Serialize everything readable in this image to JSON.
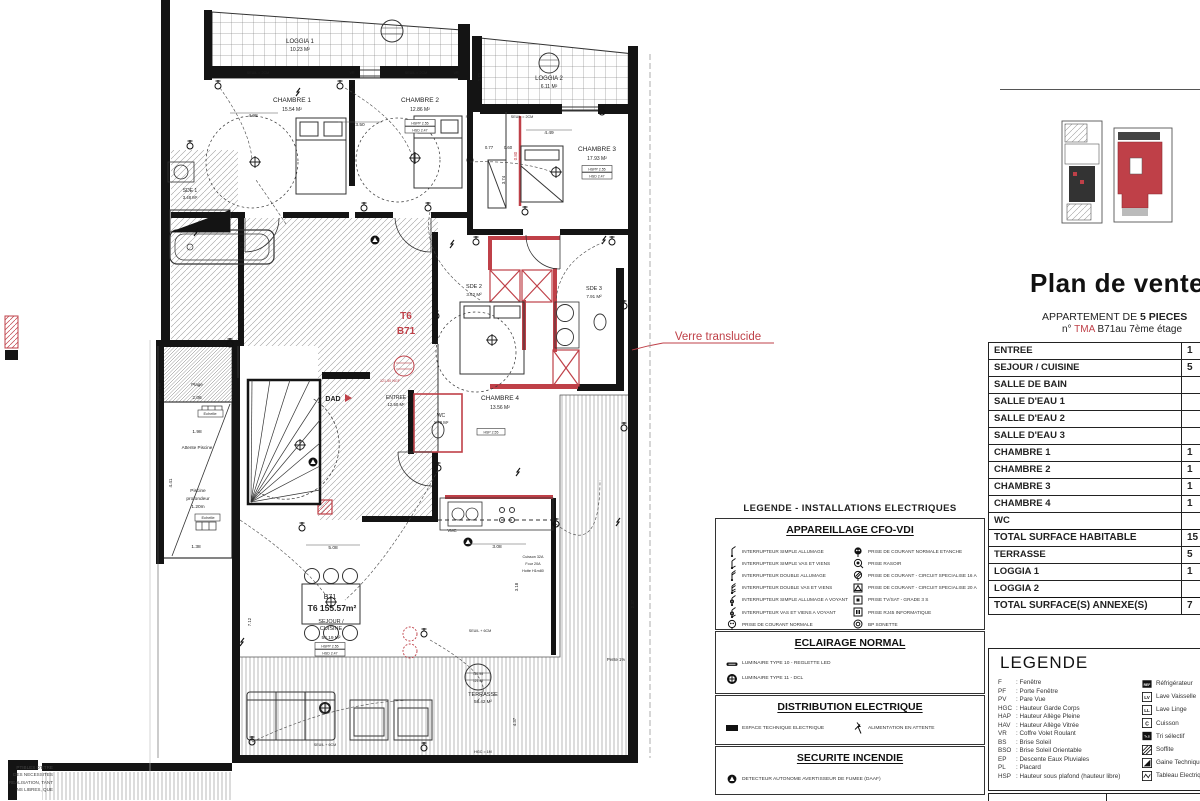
{
  "colors": {
    "accent_red": "#bf4048",
    "wall": "#141414",
    "hatch_gray": "#999999"
  },
  "title_block": {
    "title": "Plan de vente",
    "subtitle_prefix": "APPARTEMENT DE ",
    "subtitle_bold": "5 PIECES",
    "line2_prefix": "n° ",
    "line2_red": "TMA",
    "line2_suffix": " B71au 7ème étage"
  },
  "surface_table": {
    "rows": [
      {
        "label": "ENTREE",
        "value": "1",
        "total": false
      },
      {
        "label": "SEJOUR / CUISINE",
        "value": "5",
        "total": false
      },
      {
        "label": "SALLE DE BAIN",
        "value": "",
        "total": false
      },
      {
        "label": "SALLE D'EAU 1",
        "value": "",
        "total": false
      },
      {
        "label": "SALLE D'EAU 2",
        "value": "",
        "total": false
      },
      {
        "label": "SALLE D'EAU 3",
        "value": "",
        "total": false
      },
      {
        "label": "CHAMBRE 1",
        "value": "1",
        "total": false
      },
      {
        "label": "CHAMBRE 2",
        "value": "1",
        "total": false
      },
      {
        "label": "CHAMBRE 3",
        "value": "1",
        "total": false
      },
      {
        "label": "CHAMBRE 4",
        "value": "1",
        "total": false
      },
      {
        "label": "WC",
        "value": "",
        "total": false
      },
      {
        "label": "TOTAL SURFACE HABITABLE",
        "value": "15",
        "total": true
      },
      {
        "label": "TERRASSE",
        "value": "5",
        "total": false
      },
      {
        "label": "LOGGIA 1",
        "value": "1",
        "total": false
      },
      {
        "label": "LOGGIA 2",
        "value": "",
        "total": false
      },
      {
        "label": "TOTAL SURFACE(S) ANNEXE(S)",
        "value": "7",
        "total": true
      }
    ]
  },
  "abbrev_legend": {
    "title": "LEGENDE",
    "items": [
      {
        "abbr": "F",
        "desc": "Fenêtre"
      },
      {
        "abbr": "PF",
        "desc": "Porte Fenêtre"
      },
      {
        "abbr": "PV",
        "desc": "Pare Vue"
      },
      {
        "abbr": "HGC",
        "desc": "Hauteur Garde Corps"
      },
      {
        "abbr": "HAP",
        "desc": "Hauteur Allège Pleine"
      },
      {
        "abbr": "HAV",
        "desc": "Hauteur Allège Vitrée"
      },
      {
        "abbr": "VR",
        "desc": "Coffre Volet Roulant"
      },
      {
        "abbr": "BS",
        "desc": "Brise Soleil"
      },
      {
        "abbr": "BSO",
        "desc": "Brise Soleil Orientable"
      },
      {
        "abbr": "EP",
        "desc": "Descente Eaux Pluviales"
      },
      {
        "abbr": "PL",
        "desc": "Placard"
      },
      {
        "abbr": "HSP",
        "desc": "Hauteur sous plafond (hauteur libre)"
      }
    ],
    "appliances": [
      {
        "icon": "ref-box",
        "label": "Réfrigérateur"
      },
      {
        "icon": "lv-box",
        "label": "Lave Vaisselle"
      },
      {
        "icon": "ll-box",
        "label": "Lave Linge"
      },
      {
        "icon": "c-box",
        "label": "Cuisson"
      },
      {
        "icon": "trs-box",
        "label": "Tri sélectif"
      },
      {
        "icon": "soffite-hatch",
        "label": "Soffite"
      },
      {
        "icon": "gaine-triangle",
        "label": "Gaine Technique"
      },
      {
        "icon": "tableau-zigzag",
        "label": "Tableau Electrique"
      }
    ]
  },
  "electrical_legend": {
    "title": "LEGENDE - INSTALLATIONS ELECTRIQUES",
    "sections": [
      {
        "title": "APPAREILLAGE CFO-VDI",
        "left": [
          {
            "icon": "switch-simple",
            "label": "INTERRUPTEUR SIMPLE ALLUMAGE"
          },
          {
            "icon": "switch-vv",
            "label": "INTERRUPTEUR SIMPLE VAS ET VIENS"
          },
          {
            "icon": "switch-double",
            "label": "INTERRUPTEUR DOUBLE ALLUMAGE"
          },
          {
            "icon": "switch-double-vv",
            "label": "INTERRUPTEUR DOUBLE VAS ET VIENS"
          },
          {
            "icon": "switch-voyant",
            "label": "INTERRUPTEUR SIMPLE ALLUMAGE A VOYANT"
          },
          {
            "icon": "switch-vv-voyant",
            "label": "INTERRUPTEUR VAS ET VIENS A VOYANT"
          },
          {
            "icon": "outlet",
            "label": "PRISE DE COURANT NORMALE"
          }
        ],
        "right": [
          {
            "icon": "outlet-etanche",
            "label": "PRISE DE COURANT NORMALE ETANCHE"
          },
          {
            "icon": "outlet-rasoir",
            "label": "PRISE RASOIR"
          },
          {
            "icon": "outlet-16a",
            "label": "PRISE DE COURANT - CIRCUIT SPECIALISE 16 A"
          },
          {
            "icon": "outlet-20a",
            "label": "PRISE DE COURANT - CIRCUIT SPECIALISE 20 A"
          },
          {
            "icon": "tv-sat",
            "label": "PRISE TV/SAT - GRADE 3 S"
          },
          {
            "icon": "rj45",
            "label": "PRISE RJ45 INFORMATIQUE"
          },
          {
            "icon": "sonnette",
            "label": "BP SONETTE"
          }
        ]
      },
      {
        "title": "ECLAIRAGE NORMAL",
        "left": [
          {
            "icon": "reglette",
            "label": "LUMINAIRE TYPE 10 - REGLETTE LED"
          },
          {
            "icon": "dcl",
            "label": "LUMINAIRE TYPE 11 - DCL"
          }
        ],
        "right": []
      },
      {
        "title": "DISTRIBUTION ELECTRIQUE",
        "left": [
          {
            "icon": "espace-technique",
            "label": "ESPACE TECHNIQUE ELECTRIQUE"
          }
        ],
        "right": [
          {
            "icon": "alimentation-attente",
            "label": "ALIMENTATION EN ATTENTE"
          }
        ]
      },
      {
        "title": "SECURITE INCENDIE",
        "left": [
          {
            "icon": "daaf",
            "label": "DETECTEUR AUTONOME AVERTISSEUR DE FUMEE (DAAF)"
          }
        ],
        "right": []
      }
    ]
  },
  "disclaimer_lines": [
    "PTIBLES  D'ETRE",
    "DES  NECESSITES",
    "REALISATION, TANT",
    "NS  LIBRES,  QUE"
  ],
  "plan": {
    "annotation_verre": "Verre translucide",
    "labels": [
      {
        "t": "LOGGIA 1",
        "x": 300,
        "y": 43,
        "s": 6
      },
      {
        "t": "10.23 M²",
        "x": 300,
        "y": 51,
        "s": 5
      },
      {
        "t": "CHAMBRE 1",
        "x": 292,
        "y": 102,
        "s": 6.5
      },
      {
        "t": "15.54 M²",
        "x": 292,
        "y": 111,
        "s": 5
      },
      {
        "t": "CHAMBRE 2",
        "x": 420,
        "y": 102,
        "s": 6.5
      },
      {
        "t": "12.86 M²",
        "x": 420,
        "y": 111,
        "s": 5
      },
      {
        "t": "LOGGIA 2",
        "x": 549,
        "y": 80,
        "s": 6
      },
      {
        "t": "6.11 M²",
        "x": 549,
        "y": 88,
        "s": 5
      },
      {
        "t": "CHAMBRE 3",
        "x": 597,
        "y": 151,
        "s": 6.5
      },
      {
        "t": "17.93 M²",
        "x": 597,
        "y": 160,
        "s": 5
      },
      {
        "t": "SDE 2",
        "x": 474,
        "y": 288,
        "s": 5.5
      },
      {
        "t": "3.62 M²",
        "x": 474,
        "y": 296,
        "s": 4.5
      },
      {
        "t": "SDE 3",
        "x": 594,
        "y": 290,
        "s": 5.5
      },
      {
        "t": "7.91 M²",
        "x": 594,
        "y": 298,
        "s": 4.5
      },
      {
        "t": "CHAMBRE 4",
        "x": 500,
        "y": 400,
        "s": 6.5
      },
      {
        "t": "13.56 M²",
        "x": 500,
        "y": 409,
        "s": 5
      },
      {
        "t": "WC",
        "x": 441,
        "y": 417,
        "s": 5
      },
      {
        "t": "1.70 M²",
        "x": 441,
        "y": 424,
        "s": 4.3
      },
      {
        "t": "SDE 1",
        "x": 190,
        "y": 192,
        "s": 5
      },
      {
        "t": "3.48 M²",
        "x": 190,
        "y": 199,
        "s": 4.3
      },
      {
        "t": "ENTREE",
        "x": 396,
        "y": 399,
        "s": 5
      },
      {
        "t": "12.50 M²",
        "x": 396,
        "y": 406,
        "s": 4.3
      },
      {
        "t": "DAD",
        "x": 333,
        "y": 401,
        "s": 7,
        "b": 1
      },
      {
        "t": "T6",
        "x": 406,
        "y": 319,
        "s": 10,
        "b": 1,
        "c": "red"
      },
      {
        "t": "B71",
        "x": 406,
        "y": 334,
        "s": 10,
        "b": 1,
        "c": "red"
      },
      {
        "t": "B71",
        "x": 330,
        "y": 599,
        "s": 7
      },
      {
        "t": "T6  155.57m²",
        "x": 332,
        "y": 611,
        "s": 8.5,
        "b": 1
      },
      {
        "t": "SEJOUR /",
        "x": 331,
        "y": 623,
        "s": 5.5
      },
      {
        "t": "CUISINE",
        "x": 331,
        "y": 630,
        "s": 5.5
      },
      {
        "t": "54.19 M²",
        "x": 331,
        "y": 639,
        "s": 4.8
      },
      {
        "t": "TERRASSE",
        "x": 483,
        "y": 696,
        "s": 5.5
      },
      {
        "t": "58.42 M²",
        "x": 483,
        "y": 703,
        "s": 4.5
      },
      {
        "t": "121.98",
        "x": 478,
        "y": 675,
        "s": 3.3
      },
      {
        "t": "121.40",
        "x": 478,
        "y": 682,
        "s": 3.3
      },
      {
        "t": "Plage",
        "x": 197,
        "y": 386,
        "s": 4.5
      },
      {
        "t": "2.06",
        "x": 197,
        "y": 399,
        "s": 4.8
      },
      {
        "t": "Echelle",
        "x": 210,
        "y": 415,
        "s": 4
      },
      {
        "t": "1.98",
        "x": 197,
        "y": 433,
        "s": 4.8
      },
      {
        "t": "Attente Piscine",
        "x": 197,
        "y": 449,
        "s": 4.6
      },
      {
        "t": "Piscine",
        "x": 198,
        "y": 492,
        "s": 4.8
      },
      {
        "t": "profondeur",
        "x": 198,
        "y": 500,
        "s": 4.8
      },
      {
        "t": "1.20m",
        "x": 198,
        "y": 508,
        "s": 4.8
      },
      {
        "t": "Echelle",
        "x": 208,
        "y": 519,
        "s": 4
      },
      {
        "t": "1.38",
        "x": 196,
        "y": 548,
        "s": 4.8
      },
      {
        "t": "4.41",
        "x": 172,
        "y": 483,
        "s": 4.6,
        "r": -90
      },
      {
        "t": "Verre translucide",
        "x": 718,
        "y": 340,
        "s": 11.5,
        "c": "red"
      },
      {
        "t": "4.98",
        "x": 253,
        "y": 117,
        "s": 4.8
      },
      {
        "t": "3.50",
        "x": 360,
        "y": 126,
        "s": 4.8
      },
      {
        "t": "0.77",
        "x": 489,
        "y": 149,
        "s": 4.3
      },
      {
        "t": "0.60",
        "x": 508,
        "y": 149,
        "s": 4.3
      },
      {
        "t": "4.49",
        "x": 549,
        "y": 134,
        "s": 4.8
      },
      {
        "t": "3.74",
        "x": 505,
        "y": 180,
        "s": 4.3,
        "r": -90
      },
      {
        "t": "0.80",
        "x": 517,
        "y": 156,
        "s": 4.3,
        "r": -90,
        "c": "red"
      },
      {
        "t": "1.71",
        "x": 481,
        "y": 77,
        "s": 4.3,
        "r": -90
      },
      {
        "t": "0.70",
        "x": 243,
        "y": 246,
        "s": 4.3,
        "r": -90
      },
      {
        "t": "3.08",
        "x": 497,
        "y": 548,
        "s": 4.8
      },
      {
        "t": "3.18",
        "x": 518,
        "y": 587,
        "s": 4.3,
        "r": -90
      },
      {
        "t": "5.08",
        "x": 333,
        "y": 549,
        "s": 4.8
      },
      {
        "t": "7.12",
        "x": 251,
        "y": 622,
        "s": 4.3,
        "r": -90
      },
      {
        "t": "4.37",
        "x": 516,
        "y": 722,
        "s": 4.3,
        "r": -90
      },
      {
        "t": "2.37",
        "x": 634,
        "y": 604,
        "s": 4.3,
        "r": -90
      },
      {
        "t": "SEUIL = 2CM",
        "x": 258,
        "y": 74,
        "s": 3.7
      },
      {
        "t": "VR",
        "x": 352,
        "y": 74,
        "s": 3.7
      },
      {
        "t": "SEUIL = 2CM",
        "x": 416,
        "y": 74,
        "s": 3.7
      },
      {
        "t": "VR",
        "x": 456,
        "y": 74,
        "s": 3.7
      },
      {
        "t": "PF",
        "x": 468,
        "y": 118,
        "s": 3.7
      },
      {
        "t": "SEUIL = 2CM",
        "x": 522,
        "y": 118,
        "s": 3.7
      },
      {
        "t": "SEUIL + 6CM",
        "x": 325,
        "y": 746,
        "s": 3.7
      },
      {
        "t": "SEUIL + 6CM",
        "x": 480,
        "y": 632,
        "s": 3.7
      },
      {
        "t": "HGC = 1M",
        "x": 483,
        "y": 753,
        "s": 3.7
      },
      {
        "t": "Pente 1%",
        "x": 616,
        "y": 661,
        "s": 4.2
      },
      {
        "t": "VMC",
        "x": 452,
        "y": 532,
        "s": 4.2
      },
      {
        "t": "121.50 NGF",
        "x": 390,
        "y": 382,
        "s": 3.7,
        "c": "red"
      },
      {
        "t": "Cuisson 32A",
        "x": 533,
        "y": 558,
        "s": 3.7
      },
      {
        "t": "Four 20A",
        "x": 533,
        "y": 565,
        "s": 3.7
      },
      {
        "t": "Hotte H1m80",
        "x": 533,
        "y": 572,
        "s": 3.7
      },
      {
        "t": "HSPP 2.55",
        "x": 420,
        "y": 124.5,
        "s": 3.5
      },
      {
        "t": "HSD 2.47",
        "x": 420,
        "y": 131.5,
        "s": 3.5
      },
      {
        "t": "HSPP 2.55",
        "x": 597,
        "y": 170.5,
        "s": 3.5
      },
      {
        "t": "HSD 2.47",
        "x": 597,
        "y": 177.5,
        "s": 3.5
      },
      {
        "t": "HSP 2.55",
        "x": 491,
        "y": 433.5,
        "s": 3.5
      },
      {
        "t": "HSPP 2.55",
        "x": 330,
        "y": 647.5,
        "s": 3.5
      },
      {
        "t": "HSD 2.47",
        "x": 330,
        "y": 654.5,
        "s": 3.5
      },
      {
        "t": "HGC + 1.56",
        "x": 161,
        "y": 392,
        "s": 3.5,
        "r": -90
      }
    ]
  }
}
